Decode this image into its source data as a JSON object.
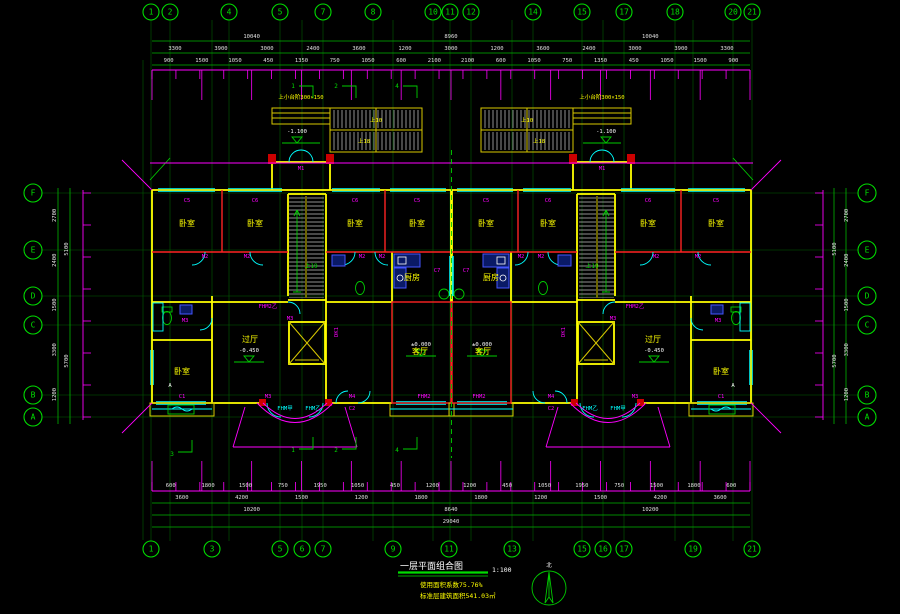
{
  "drawing": {
    "title": "一层平面组合图",
    "scale": "1:100",
    "note1": "使用面积系数75.76%",
    "note2": "标准层建筑面积541.03㎡",
    "north_label": "北",
    "colors": {
      "axis": "#00dd00",
      "dims": "#ff00ff",
      "walls": "#ffff00",
      "partitions": "#ff2222",
      "openings": "#00ffff",
      "rooms": "#ffff00"
    }
  },
  "axes": {
    "top": [
      "1",
      "2",
      "4",
      "5",
      "7",
      "8",
      "10",
      "11",
      "12",
      "14",
      "15",
      "17",
      "18",
      "20",
      "21"
    ],
    "bottom": [
      "1",
      "3",
      "5",
      "6",
      "7",
      "9",
      "11",
      "13",
      "15",
      "16",
      "17",
      "19",
      "21"
    ],
    "letters": [
      "F",
      "E",
      "D",
      "C",
      "B",
      "A"
    ]
  },
  "dims": {
    "top_row1": [
      "10040",
      "8960",
      "10040"
    ],
    "top_row2": [
      "3300",
      "3900",
      "3000",
      "2400",
      "3600",
      "1200",
      "3000",
      "1200",
      "3600",
      "2400",
      "3000",
      "3900",
      "3300"
    ],
    "top_row3": [
      "900",
      "1500",
      "1050",
      "450",
      "1350",
      "750",
      "1050",
      "600",
      "2100",
      "2100",
      "600",
      "1050",
      "750",
      "1350",
      "450",
      "1050",
      "1500",
      "900"
    ],
    "bottom_row1": [
      "600",
      "1800",
      "1500",
      "750",
      "1950",
      "1050",
      "450",
      "1200",
      "1200",
      "450",
      "1050",
      "1950",
      "750",
      "1500",
      "1800",
      "600"
    ],
    "bottom_row2": [
      "3600",
      "4200",
      "1500",
      "1200",
      "1800",
      "1800",
      "1200",
      "1500",
      "4200",
      "3600"
    ],
    "bottom_row3": [
      "10200",
      "8640",
      "10200"
    ],
    "bottom_row4": [
      "29040"
    ],
    "left_col1": [
      "2700",
      "2400",
      "1500",
      "3300",
      "1200"
    ],
    "left_col2": [
      "5100",
      "5700"
    ]
  },
  "rooms": {
    "bedroom": "卧室",
    "living": "客厅",
    "hall": "过厅",
    "kitchen": "厨房"
  },
  "tags": {
    "c1": "C1",
    "c2": "C2",
    "c5": "C5",
    "c6": "C6",
    "c7": "C7",
    "m1": "M1",
    "m2": "M2",
    "m3": "M3",
    "m4": "M4",
    "fhm2": "FHM2",
    "fhm2b": "FHM2乙",
    "fhmj": "FHM甲",
    "fhmy": "FHM乙",
    "dk1": "DK1",
    "up10": "上10",
    "up18": "上18",
    "up19": "上19",
    "mark_a": "A",
    "steps_note": "上小台阶300×150"
  },
  "levels": {
    "entry": "-1.100",
    "hall": "-0.450",
    "floor": "±0.000"
  },
  "callouts": {
    "n1": "1",
    "n2": "2",
    "n3": "3",
    "n4": "4"
  }
}
